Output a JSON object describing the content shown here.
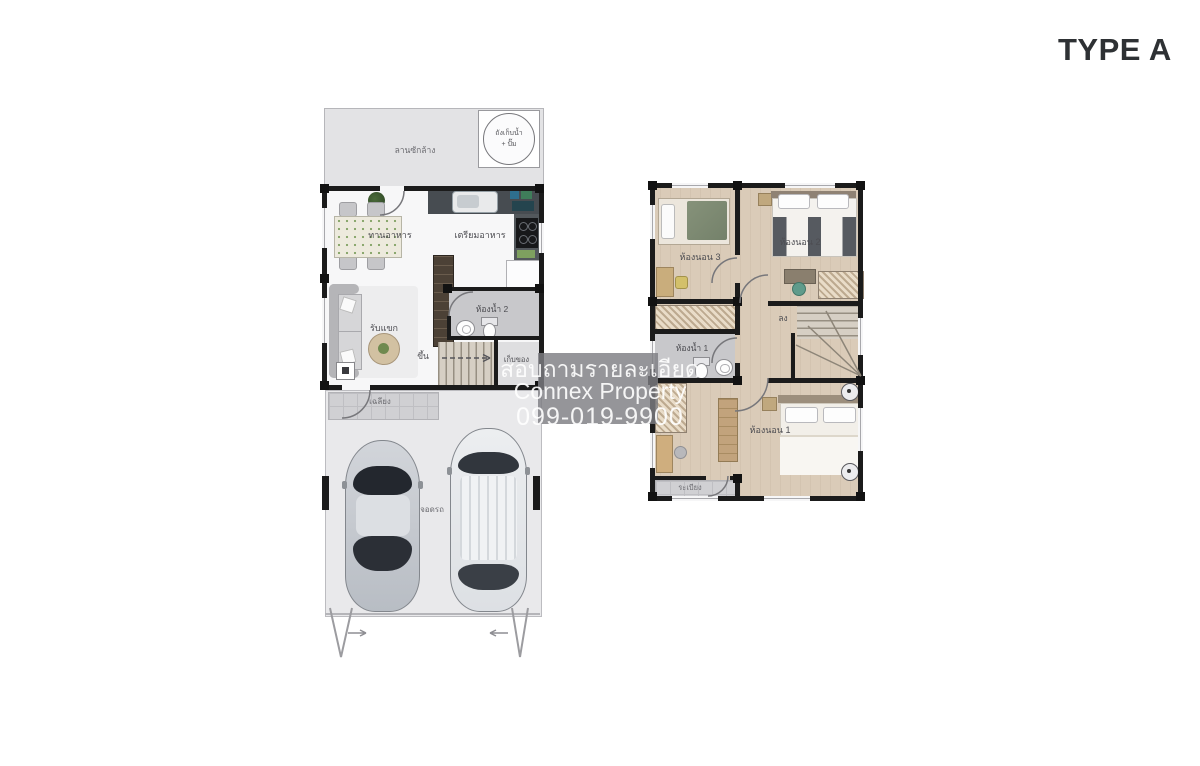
{
  "page": {
    "title": "TYPE A"
  },
  "colors": {
    "wall": "#1b1b1b",
    "wood_floor": "#dacbb8",
    "tile_grey": "#d0d0d3",
    "watermark_bg": "#7e7e82",
    "watermark_text": "#ffffff"
  },
  "watermark": {
    "line1": "สอบถามรายละเอียด",
    "line2": "Connex Property",
    "line3": "099-019-9900"
  },
  "floor1": {
    "labels": {
      "laundry": "ลานซักล้าง",
      "tank_line1": "ถังเก็บน้ำ",
      "tank_line2": "+ ปั๊ม",
      "dining": "ทานอาหาร",
      "kitchen": "เตรียมอาหาร",
      "bath2": "ห้องน้ำ 2",
      "living": "รับแขก",
      "up": "ขึ้น",
      "storage": "เก็บของ",
      "porch": "เฉลียง",
      "parking": "จอดรถ"
    }
  },
  "floor2": {
    "labels": {
      "bed3": "ห้องนอน 3",
      "bed2": "ห้องนอน 2",
      "bath1": "ห้องน้ำ 1",
      "down": "ลง",
      "bed1": "ห้องนอน 1",
      "balcony": "ระเบียง"
    }
  }
}
